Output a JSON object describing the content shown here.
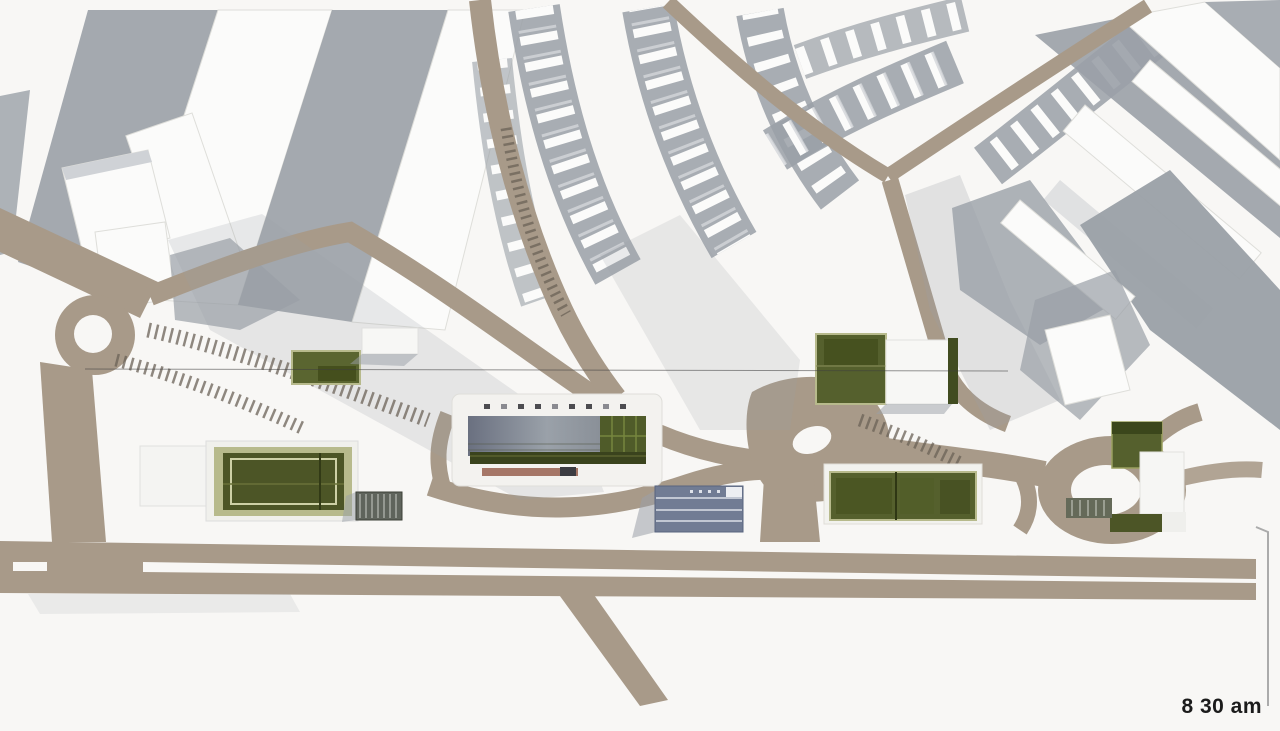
{
  "timestamp": {
    "label": "8 30 am"
  },
  "colors": {
    "background": "#f8f7f5",
    "road": "#a89a89",
    "road_shaded": "#8f8274",
    "shadow": "#9aa0a7",
    "shadow_light": "#c2c5ca",
    "building_white": "#fbfbfa",
    "building_edge": "#dededa",
    "green_dark": "#4c5526",
    "green_mid": "#55602d",
    "green_light": "#b7ba8c",
    "glass_dark": "#6e7482",
    "glass_light": "#9aa0a8",
    "blue_building": "#717c94",
    "louver_gray": "#5f645c",
    "red_strip": "#96604f",
    "hatch": "#6b6257",
    "text": "#1b1b1b",
    "frame_line": "#ababab"
  }
}
